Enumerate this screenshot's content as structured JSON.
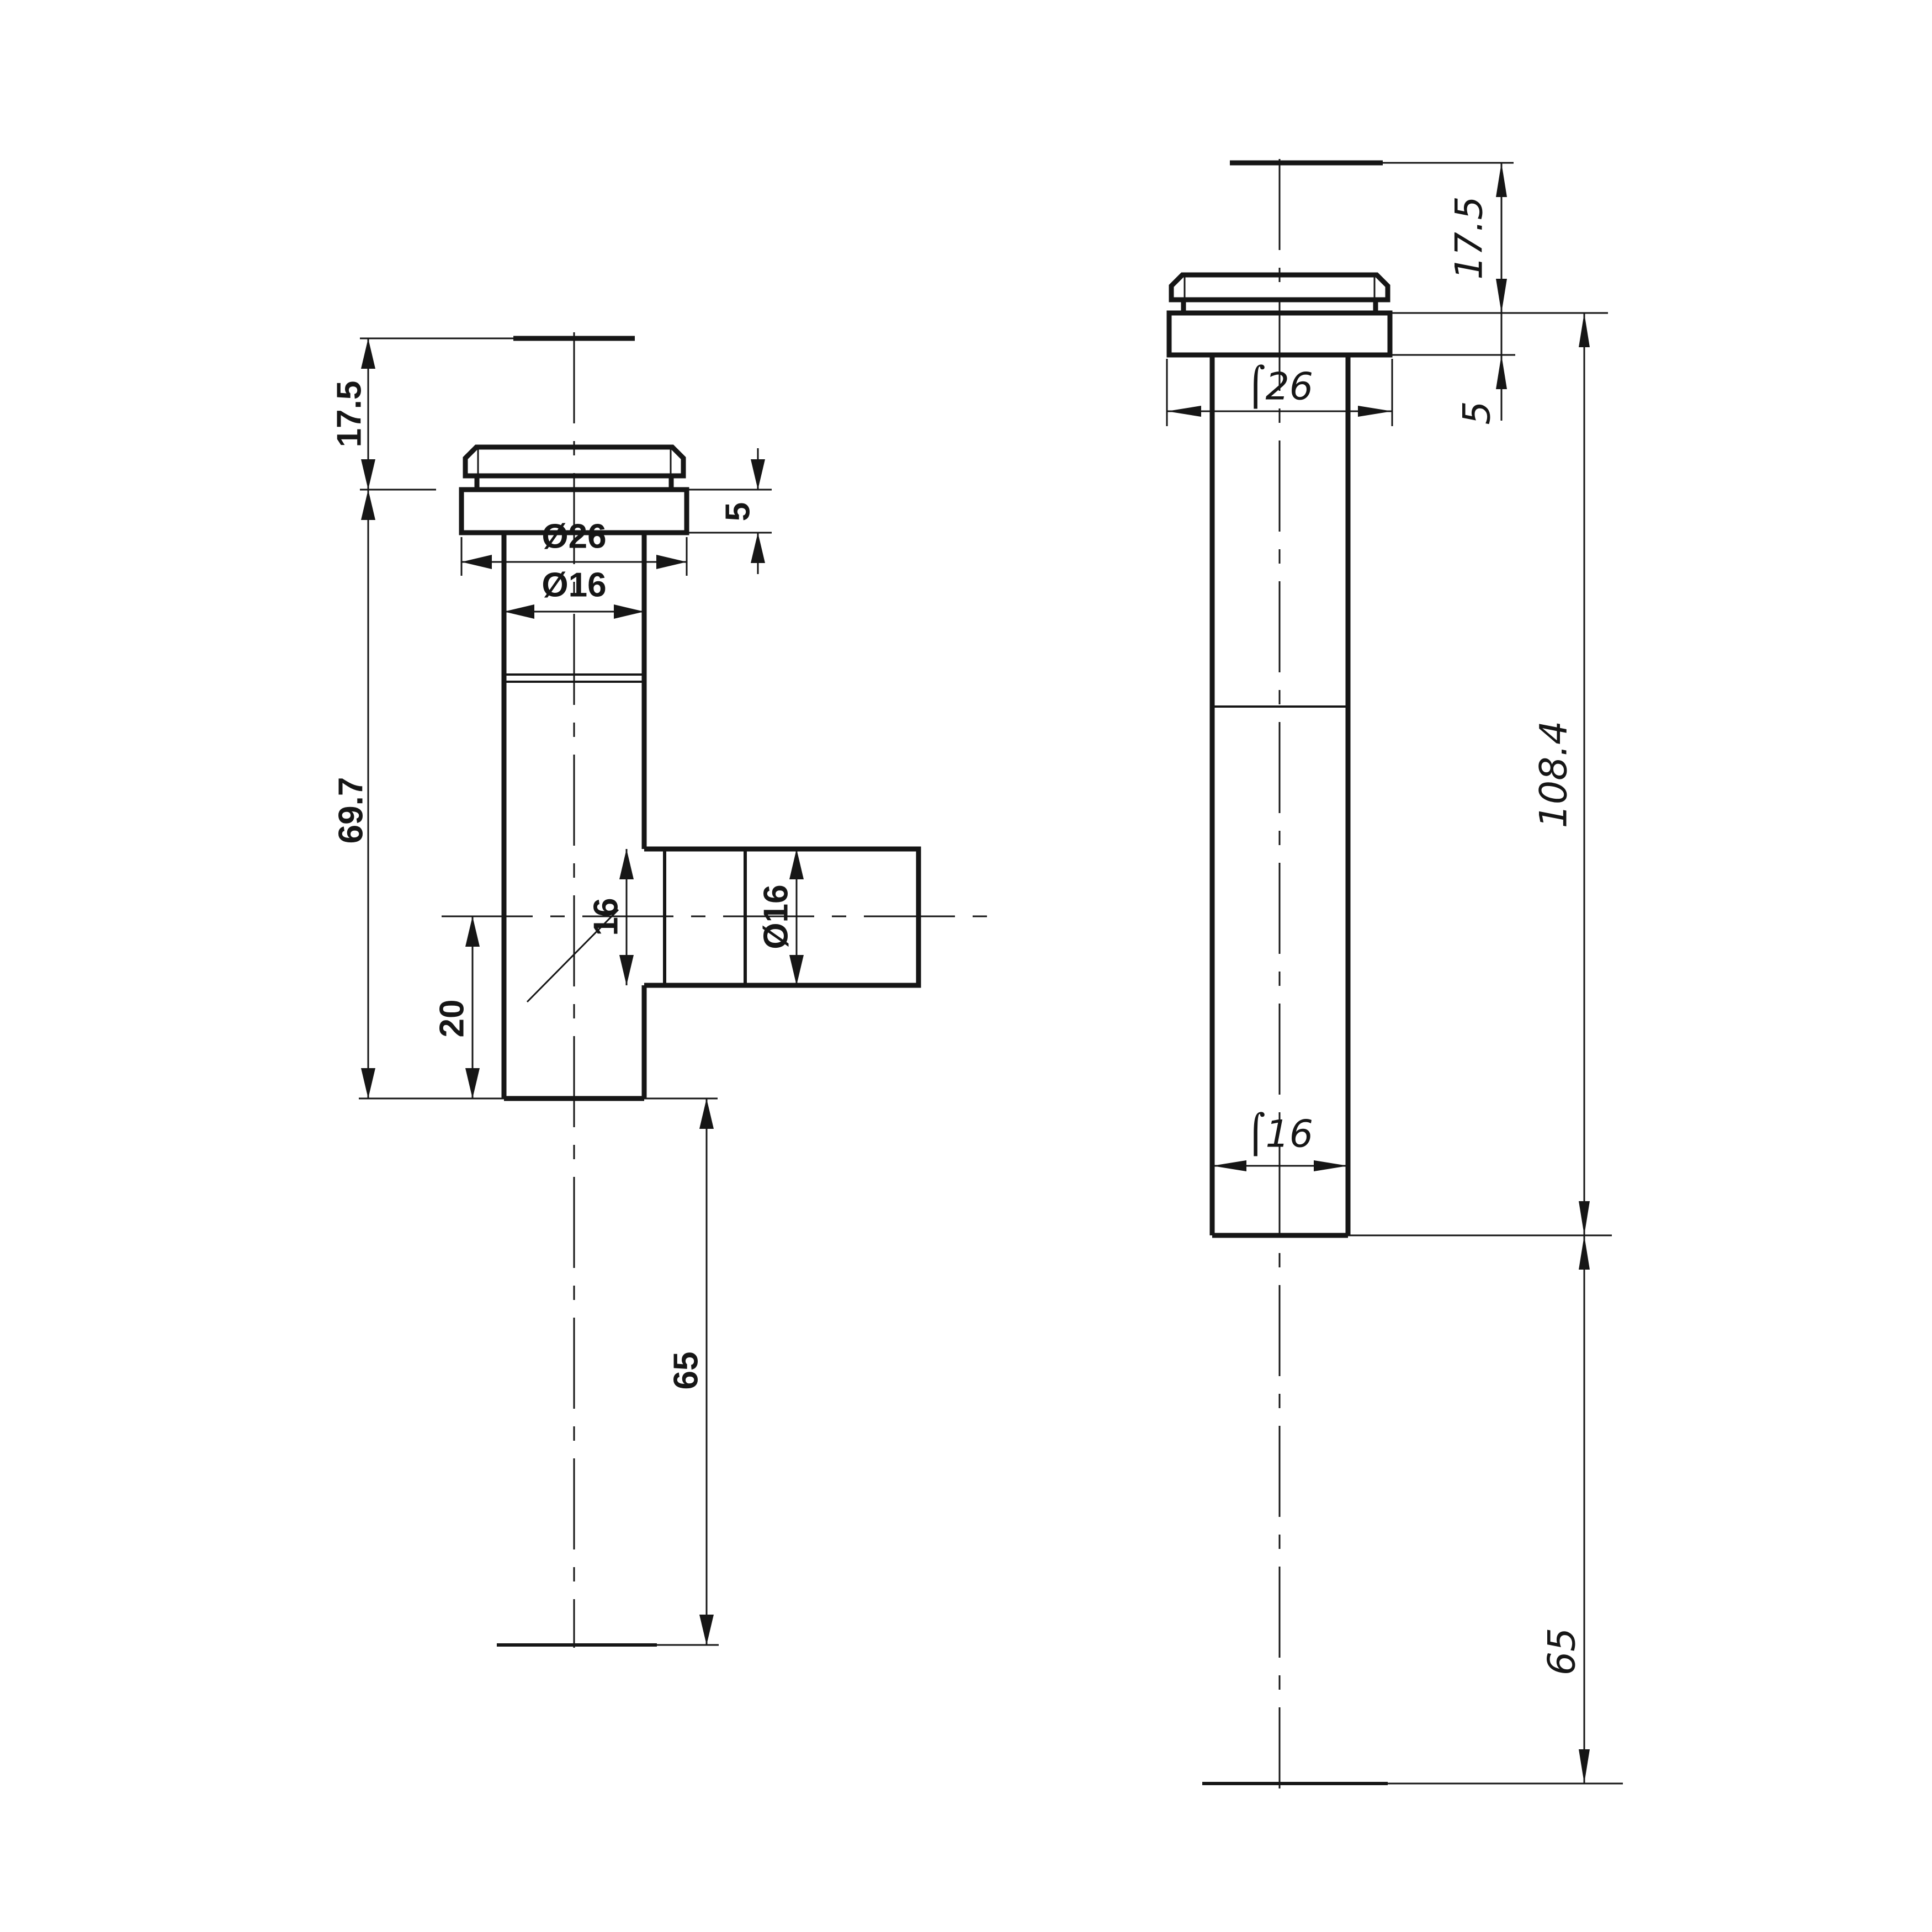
{
  "document": {
    "kind": "engineering drawing, two orthographic views of a tube fitting",
    "paper_color": "#ffffff",
    "ink_color": "#161616"
  },
  "left_view": {
    "name": "front view - tee fitting",
    "dims": {
      "top_height": "17.5",
      "body_length": "69.7",
      "flange_thickness": "5",
      "flange_diameter": "Ø26",
      "tube_diameter": "Ø16",
      "branch_width": "16",
      "branch_diameter": "Ø16",
      "branch_offset": "20",
      "tail_length": "65"
    }
  },
  "right_view": {
    "name": "side view - straight fitting",
    "dims": {
      "top_height": "17.5",
      "flange_thickness": "5",
      "flange_diameter": "⌠26",
      "body_length": "108.4",
      "tube_diameter": "⌠16",
      "tail_length": "65"
    }
  }
}
